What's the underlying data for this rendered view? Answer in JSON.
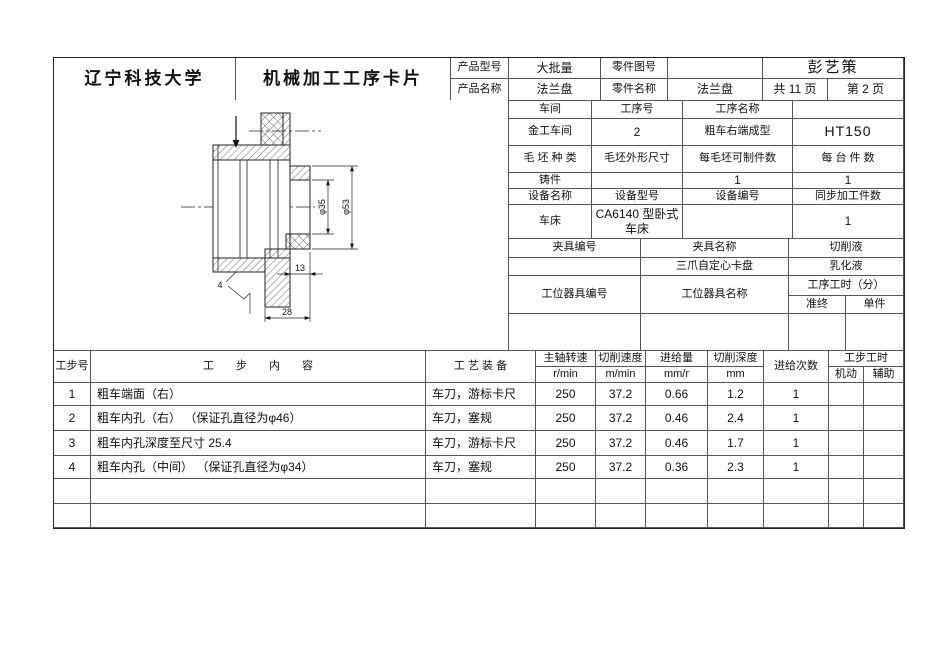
{
  "header": {
    "university": "辽宁科技大学",
    "card_title": "机械加工工序卡片",
    "product_model_label": "产品型号",
    "product_model_value": "大批量",
    "part_drawing_no_label": "零件图号",
    "part_drawing_no_value": "",
    "author": "彭艺策",
    "product_name_label": "产品名称",
    "product_name_value": "法兰盘",
    "part_name_label": "零件名称",
    "part_name_value": "法兰盘",
    "pages_total": "共  11  页",
    "page_current": "第  2  页"
  },
  "info": {
    "workshop_label": "车间",
    "process_no_label": "工序号",
    "process_name_label": "工序名称",
    "material_header": "",
    "workshop_value": "金工车间",
    "process_no_value": "2",
    "process_name_value": "粗车右端成型",
    "material_value": "HT150",
    "blank_type_label": "毛 坯 种 类",
    "blank_size_label": "毛坯外形尺寸",
    "parts_per_blank_label": "每毛坯可制件数",
    "parts_per_machine_label": "每 台 件 数",
    "blank_type_value": "铸件",
    "blank_size_value": "",
    "parts_per_blank_value": "1",
    "parts_per_machine_value": "1",
    "equipment_name_label": "设备名称",
    "equipment_model_label": "设备型号",
    "equipment_no_label": "设备编号",
    "sync_parts_label": "同步加工件数",
    "equipment_name_value": "车床",
    "equipment_model_value": "CA6140 型卧式车床",
    "equipment_no_value": "",
    "sync_parts_value": "1",
    "fixture_no_label": "夹具编号",
    "fixture_name_label": "夹具名称",
    "coolant_label": "切削液",
    "fixture_no_value": "",
    "fixture_name_value": "三爪自定心卡盘",
    "coolant_value": "乳化液",
    "tooling_no_label": "工位器具编号",
    "tooling_name_label": "工位器具名称",
    "process_time_label": "工序工时（分）",
    "prep_time_label": "准终",
    "unit_time_label": "单件"
  },
  "steps": {
    "col_step_no": "工步号",
    "col_content": "工　　步　　内　　容",
    "col_equipment": "工 艺 装 备",
    "col_spindle": "主轴转速",
    "col_spindle_unit": "r/min",
    "col_speed": "切削速度",
    "col_speed_unit": "m/min",
    "col_feed": "进给量",
    "col_feed_unit": "mm/r",
    "col_depth": "切削深度",
    "col_depth_unit": "mm",
    "col_passes": "进给次数",
    "col_time": "工步工时",
    "col_time_machine": "机动",
    "col_time_aux": "辅助",
    "rows": [
      {
        "no": "1",
        "content": "粗车端面（右）",
        "equipment": "车刀，游标卡尺",
        "spindle": "250",
        "speed": "37.2",
        "feed": "0.66",
        "depth": "1.2",
        "passes": "1",
        "machine": "",
        "aux": ""
      },
      {
        "no": "2",
        "content": "粗车内孔（右） （保证孔直径为φ46）",
        "equipment": "车刀，塞规",
        "spindle": "250",
        "speed": "37.2",
        "feed": "0.46",
        "depth": "2.4",
        "passes": "1",
        "machine": "",
        "aux": ""
      },
      {
        "no": "3",
        "content": "粗车内孔深度至尺寸 25.4",
        "equipment": "车刀，游标卡尺",
        "spindle": "250",
        "speed": "37.2",
        "feed": "0.46",
        "depth": "1.7",
        "passes": "1",
        "machine": "",
        "aux": ""
      },
      {
        "no": "4",
        "content": "粗车内孔（中间） （保证孔直径为φ34）",
        "equipment": "车刀，塞规",
        "spindle": "250",
        "speed": "37.2",
        "feed": "0.36",
        "depth": "2.3",
        "passes": "1",
        "machine": "",
        "aux": ""
      },
      {
        "no": "",
        "content": "",
        "equipment": "",
        "spindle": "",
        "speed": "",
        "feed": "",
        "depth": "",
        "passes": "",
        "machine": "",
        "aux": ""
      },
      {
        "no": "",
        "content": "",
        "equipment": "",
        "spindle": "",
        "speed": "",
        "feed": "",
        "depth": "",
        "passes": "",
        "machine": "",
        "aux": ""
      }
    ]
  },
  "drawing": {
    "dim_bore": "φ35",
    "dim_boss": "φ53",
    "dim_depth": "13",
    "dim_length": "28",
    "chamfer_note": "4"
  }
}
